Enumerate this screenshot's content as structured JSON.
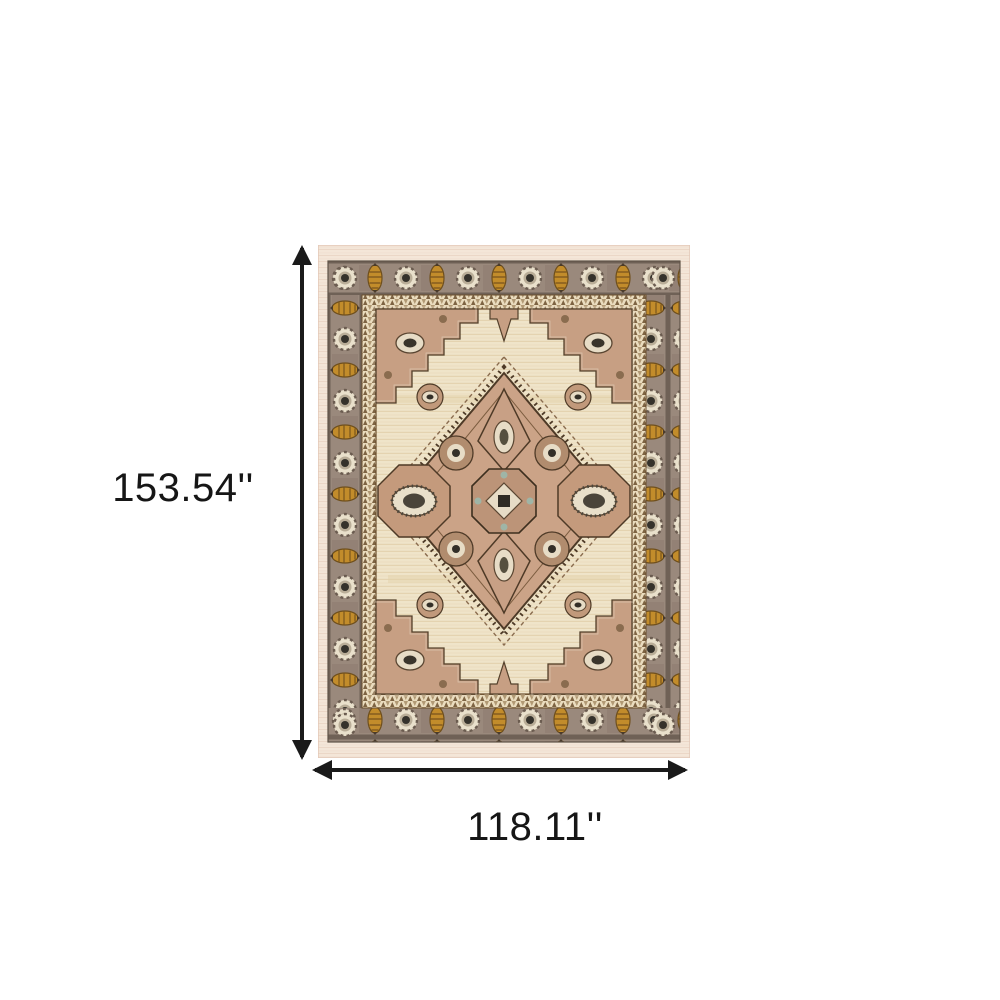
{
  "image": {
    "type": "product-dimension-illustration",
    "background": "#ffffff"
  },
  "product": {
    "name": "oriental-medallion-area-rug",
    "style": "persian medallion rug, ivory field, taupe border, blush medallion, gold palmette accents"
  },
  "dimensions": {
    "height_label": "153.54''",
    "width_label": "118.11''"
  },
  "colors": {
    "dimension_line": "#1a1a1a",
    "label_text": "#161616",
    "rug_outer_band": "#f4e6d8",
    "rug_border_taupe": "#9a897c",
    "rug_guard_ivory": "#eadcbe",
    "rug_field_ivory": "#efe4c9",
    "rug_blush": "#c7a189",
    "rug_gold": "#c28c2b",
    "rug_dark_brown": "#4e3a27",
    "rug_teal_accent": "#9fb5a6"
  }
}
